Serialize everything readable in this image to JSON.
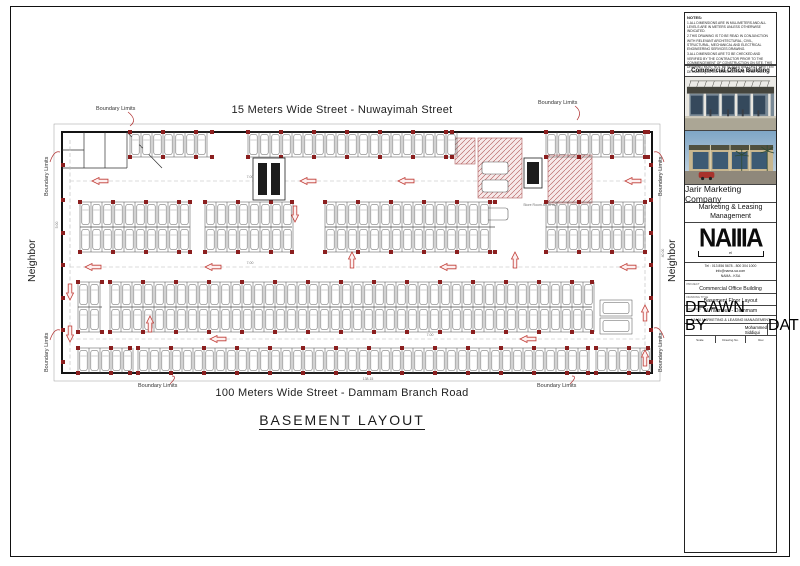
{
  "labels": {
    "top_street": "15 Meters Wide Street  - Nuwayimah Street",
    "bottom_street": "100 Meters Wide Street  - Dammam Branch Road",
    "drawing_title": "BASEMENT LAYOUT",
    "boundary": "Boundary Limits",
    "neighbor": "Neighbor"
  },
  "notes": {
    "title": "NOTES:",
    "items": [
      "1.ALL DIMENSIONS ARE IN MILLIMETERS AND ALL LEVELS ARE IN METERS UNLESS OTHERWISE INDICATED.",
      "2.THIS DRAWING IS TO BE READ IN CONJUNCTION WITH RELEVANT ARCHITECTURAL, CIVIL, STRUCTURAL, MECHANICAL AND ELECTRICAL ENGINEERING SERVICES DRAWING.",
      "3.ALL DIMENSIONS ARE TO BE CHECKED AND VERIFIED BY THE CONTRACTOR PRIOR TO THE COMMENCEMENT OF CONSTRUCTION ON SITE. THIS DRAWING MUST NOT BE SCALED AND ONLY WRITTEN DETAILED/QUOTED DIMENSION ARE TO BE USED."
    ]
  },
  "titleblock": {
    "header": "Commercial Office Building",
    "company": "Jarir Marketing Company",
    "department": "Marketing & Leasing Management",
    "logo_text": "NAIIIA",
    "logo_sub": "el",
    "contact_line1": "Tel : 013 856 5678 - 800 304 1000",
    "contact_line2": "info@nama-sa.com",
    "contact_line3": "NAMA - KSA",
    "project_label": "PROJECT",
    "project": "Commercial Office Building",
    "drawing_label": "DRAWING TITLE",
    "drawing": "Basement Floor Layout",
    "location_label": "LOCATION",
    "location": "Al Yarmouk - Dammam",
    "firm": "NAMA MARKETING & LEASING MANAGEMENT",
    "drawn_label": "DRAWN BY",
    "drawn": "Mohammed Siddiqui",
    "date_label": "DATE",
    "date": "12 Oct 2020",
    "footer_cells": [
      "Scale",
      "Drawing No.",
      "Rev."
    ]
  },
  "plan": {
    "stall_w": 11,
    "stall_depth": 25,
    "boundary": [
      54,
      124,
      606,
      257
    ],
    "walls": [
      62,
      132,
      590,
      241
    ],
    "rooms": [
      [
        62,
        168,
        127,
        168
      ],
      [
        84,
        132,
        84,
        168
      ],
      [
        105,
        132,
        105,
        168
      ],
      [
        127,
        132,
        127,
        168
      ],
      [
        127,
        132,
        162,
        168
      ],
      [
        62,
        150,
        84,
        150
      ]
    ],
    "rows": [
      {
        "y": 132,
        "double": false,
        "segs": [
          [
            130,
            212
          ],
          [
            248,
            452
          ],
          [
            546,
            648
          ]
        ]
      },
      {
        "y": 202,
        "double": true,
        "segs": [
          [
            80,
            190
          ],
          [
            205,
            292
          ],
          [
            325,
            495
          ],
          [
            546,
            645
          ]
        ]
      },
      {
        "y": 282,
        "double": true,
        "segs": [
          [
            78,
            102
          ],
          [
            110,
            592
          ]
        ]
      },
      {
        "y": 348,
        "double": false,
        "segs": [
          [
            78,
            130
          ],
          [
            138,
            588
          ],
          [
            596,
            648
          ]
        ]
      }
    ],
    "wall_col_ys": [
      165,
      200,
      233,
      265,
      298,
      330,
      362
    ],
    "aisle_lines": [
      [
        70,
        181,
        645,
        181
      ],
      [
        70,
        267,
        645,
        267
      ],
      [
        70,
        339,
        645,
        339
      ],
      [
        70,
        140,
        70,
        370
      ],
      [
        645,
        140,
        645,
        370
      ]
    ],
    "arrows": [
      {
        "d": "L",
        "x": 92,
        "y": 181
      },
      {
        "d": "L",
        "x": 300,
        "y": 181
      },
      {
        "d": "L",
        "x": 398,
        "y": 181
      },
      {
        "d": "L",
        "x": 625,
        "y": 181
      },
      {
        "d": "D",
        "x": 295,
        "y": 222
      },
      {
        "d": "U",
        "x": 352,
        "y": 252
      },
      {
        "d": "U",
        "x": 515,
        "y": 252
      },
      {
        "d": "L",
        "x": 85,
        "y": 267
      },
      {
        "d": "L",
        "x": 205,
        "y": 267
      },
      {
        "d": "L",
        "x": 440,
        "y": 267
      },
      {
        "d": "L",
        "x": 620,
        "y": 267
      },
      {
        "d": "D",
        "x": 70,
        "y": 300
      },
      {
        "d": "D",
        "x": 70,
        "y": 342
      },
      {
        "d": "U",
        "x": 150,
        "y": 316
      },
      {
        "d": "U",
        "x": 645,
        "y": 305
      },
      {
        "d": "L",
        "x": 210,
        "y": 339
      },
      {
        "d": "L",
        "x": 520,
        "y": 339
      },
      {
        "d": "U",
        "x": 645,
        "y": 350
      }
    ],
    "hatches": [
      [
        478,
        138,
        44,
        60
      ],
      [
        548,
        155,
        44,
        48
      ],
      [
        455,
        138,
        20,
        26
      ]
    ],
    "cars_h": [
      [
        482,
        162
      ],
      [
        482,
        180
      ],
      [
        482,
        208
      ]
    ],
    "cores": [
      {
        "o": [
          253,
          158,
          32,
          42
        ],
        "lifts": [
          [
            258,
            163,
            9,
            32
          ],
          [
            271,
            163,
            9,
            32
          ]
        ]
      },
      {
        "o": [
          524,
          158,
          18,
          30
        ],
        "lifts": [
          [
            527,
            162,
            12,
            22
          ]
        ]
      }
    ],
    "stalls_h": [
      [
        600,
        300,
        32,
        16
      ],
      [
        600,
        318,
        32,
        16
      ]
    ],
    "dims": [
      {
        "t": "138.15",
        "x": 368,
        "y": 380,
        "r": 0
      },
      {
        "t": "40.00",
        "x": 664,
        "y": 253,
        "r": -90
      },
      {
        "t": "7.00",
        "x": 250,
        "y": 178,
        "r": 0
      },
      {
        "t": "7.00",
        "x": 250,
        "y": 264,
        "r": 0
      },
      {
        "t": "7.00",
        "x": 430,
        "y": 336,
        "r": 0
      },
      {
        "t": "5.00",
        "x": 58,
        "y": 225,
        "r": -90
      },
      {
        "t": "Store Room A=70 m2",
        "x": 540,
        "y": 206,
        "r": 0
      }
    ],
    "leaders": [
      "M128,112 q10,8 2,14",
      "M575,106 q8,6 2,14",
      "M170,384 q8,-8 2,-8",
      "M570,384 q8,-8 2,-8",
      "M50,162 q4,-12 10,-10",
      "M50,340 q4,-12 10,-10",
      "M664,162 q-4,-12 -10,-10",
      "M664,338 q-4,-12 -10,-10"
    ]
  }
}
